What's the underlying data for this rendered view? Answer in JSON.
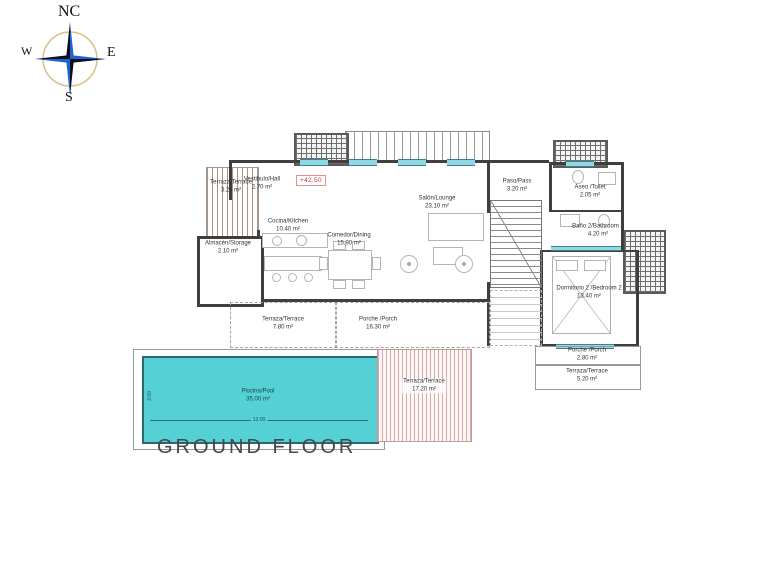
{
  "meta": {
    "title": "GROUND FLOOR"
  },
  "compass": {
    "north": "NC",
    "west": "W",
    "east": "E",
    "south": "S"
  },
  "level_marker": "+42.50",
  "rooms": [
    {
      "label": "Terraza/Terrace",
      "area": "3.28 m²"
    },
    {
      "label": "Vestibulo/Hall",
      "area": "2.70 m²"
    },
    {
      "label": "Almacén/Storage",
      "area": "2.10 m²"
    },
    {
      "label": "Cocina/Kitchen",
      "area": "10.40 m²"
    },
    {
      "label": "Comedor/Dining",
      "area": "15.90 m²"
    },
    {
      "label": "Salón/Lounge",
      "area": "23.10 m²"
    },
    {
      "label": "Paso/Pass",
      "area": "3.20 m²"
    },
    {
      "label": "Aseo /Toilet",
      "area": "2.05 m²"
    },
    {
      "label": "Baño 2/Bathroom 2",
      "area": "4.20 m²"
    },
    {
      "label": "Dormitorio 2 /Bedroom 2",
      "area": "13.40 m²"
    },
    {
      "label": "Terraza/Terrace",
      "area": "7.80 m²"
    },
    {
      "label": "Porche /Porch",
      "area": "16.30 m²"
    },
    {
      "label": "Terraza/Terrace",
      "area": "17.20 m²"
    },
    {
      "label": "Piscina/Pool",
      "area": "35.00 m²"
    },
    {
      "label": "Porche /Porch",
      "area": "2.80 m²"
    },
    {
      "label": "Terraza/Terrace",
      "area": "5.20 m²"
    }
  ],
  "pool": {
    "length": "13.00",
    "width": "3.00"
  },
  "colors": {
    "pool_fill": "#55d0d5",
    "pool_border": "#2b686d",
    "wall": "#3f3f3f",
    "terrace_hatch": "#d9aaa4",
    "window_glass": "#8fd9e6",
    "level_red": "#cc3333",
    "compass_blue": "#1f63d0",
    "compass_ring": "#d9c084"
  }
}
